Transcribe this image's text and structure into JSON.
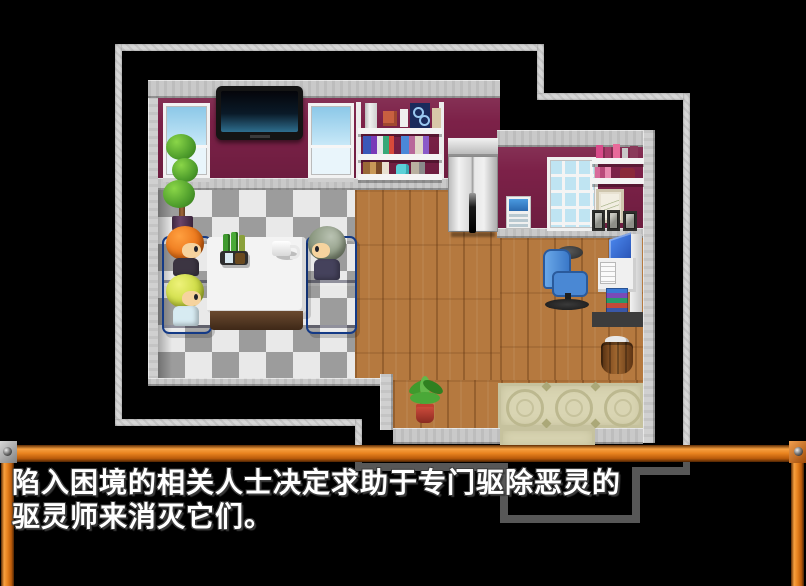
{
  "scene": {
    "kind": "rpg-maker-game-screen",
    "dialogue": {
      "line1": "陷入困境的相关人士决定求助于专门驱除恶灵的",
      "line2": "驱灵师来消灭它们。"
    },
    "colors": {
      "frame_orange": "#e8821e",
      "wall_maroon": "#7c2148",
      "wood_floor": "#b5793f",
      "sofa_blue": "#3668d2",
      "mat_beige": "#d9d5b3",
      "outline_gray": "#d6d6d6",
      "band_gray": "#c9c9c9",
      "window_sky": "#c9e9f8",
      "dialogue_text": "#ffffff"
    },
    "objects": [
      {
        "name": "flat-screen-tv"
      },
      {
        "name": "window-left-1"
      },
      {
        "name": "window-left-2"
      },
      {
        "name": "wall-shelf-books"
      },
      {
        "name": "elevator-double-door"
      },
      {
        "name": "wall-poster"
      },
      {
        "name": "window-right"
      },
      {
        "name": "cosmetics-shelves"
      },
      {
        "name": "picture-frames"
      },
      {
        "name": "topiary-plant"
      },
      {
        "name": "sofa-left"
      },
      {
        "name": "sofa-right"
      },
      {
        "name": "coffee-table"
      },
      {
        "name": "drink-tray"
      },
      {
        "name": "coffee-mug"
      },
      {
        "name": "character-orange-hair"
      },
      {
        "name": "character-blonde-hair"
      },
      {
        "name": "character-gray-hair"
      },
      {
        "name": "office-chair"
      },
      {
        "name": "computer-desk"
      },
      {
        "name": "book-stack"
      },
      {
        "name": "trash-barrel"
      },
      {
        "name": "potted-plant"
      },
      {
        "name": "entrance-mat"
      }
    ]
  }
}
